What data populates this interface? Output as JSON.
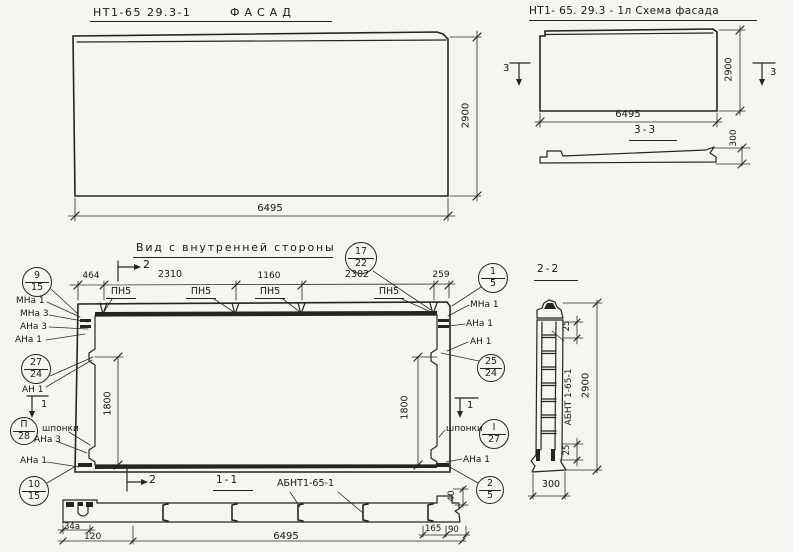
{
  "drawing": {
    "facade": {
      "code": "НТ1-65 29.3-1",
      "title": "ФАСАД",
      "dim_width": "6495",
      "dim_height": "2900"
    },
    "scheme": {
      "title": "НТ1- 65. 29.3 - 1л Схема фасада",
      "dim_width": "6495",
      "dim_height": "2900",
      "cut_left": "3",
      "cut_right": "3",
      "section_title": "3-3",
      "dim_thickness": "300"
    },
    "inner": {
      "title": "Вид с внутренней стороны",
      "dims_top": [
        "464",
        "2310",
        "1160",
        "2302",
        "259"
      ],
      "pn1": "ПН5",
      "pn2": "ПН5",
      "pn3": "ПН5",
      "pn4": "ПН5",
      "dim_left": "1800",
      "dim_right": "1800",
      "keys_left": "шпонки",
      "keys_right": "шпонки",
      "cut_top": "2",
      "cut_bottom": "2",
      "cut_side_left": "1",
      "cut_side_right": "1",
      "labels": {
        "lt1": "МНа 1",
        "lt2": "МНа 3",
        "lt3": "АНа 3",
        "lt4": "АНа 1",
        "rt1": "МНа 1",
        "rt2": "АНа 1",
        "rt3": "АН 1",
        "lm1": "АН 1",
        "lb1": "АНа 3",
        "lb2": "АНа 1",
        "rb1": "АНа 1"
      },
      "balloons": [
        {
          "top": "9",
          "bottom": "15"
        },
        {
          "top": "17",
          "bottom": "22"
        },
        {
          "top": "1",
          "bottom": "5"
        },
        {
          "top": "27",
          "bottom": "24"
        },
        {
          "top": "П",
          "bottom": "28"
        },
        {
          "top": "10",
          "bottom": "15"
        },
        {
          "top": "25",
          "bottom": "24"
        },
        {
          "top": "I",
          "bottom": "27"
        },
        {
          "top": "2",
          "bottom": "5"
        }
      ]
    },
    "section11": {
      "title": "1-1",
      "part": "АБНТ1-65-1",
      "dim_hook": "34а",
      "dim_120": "120",
      "dim_width": "6495",
      "dim_165": "165",
      "dim_90": "90",
      "dim_40": "40"
    },
    "section22": {
      "title": "2-2",
      "part": "АБНТ 1-65-1",
      "dim_height": "2900",
      "dim_top": "25",
      "dim_bottom": "25",
      "dim_width": "300"
    }
  }
}
